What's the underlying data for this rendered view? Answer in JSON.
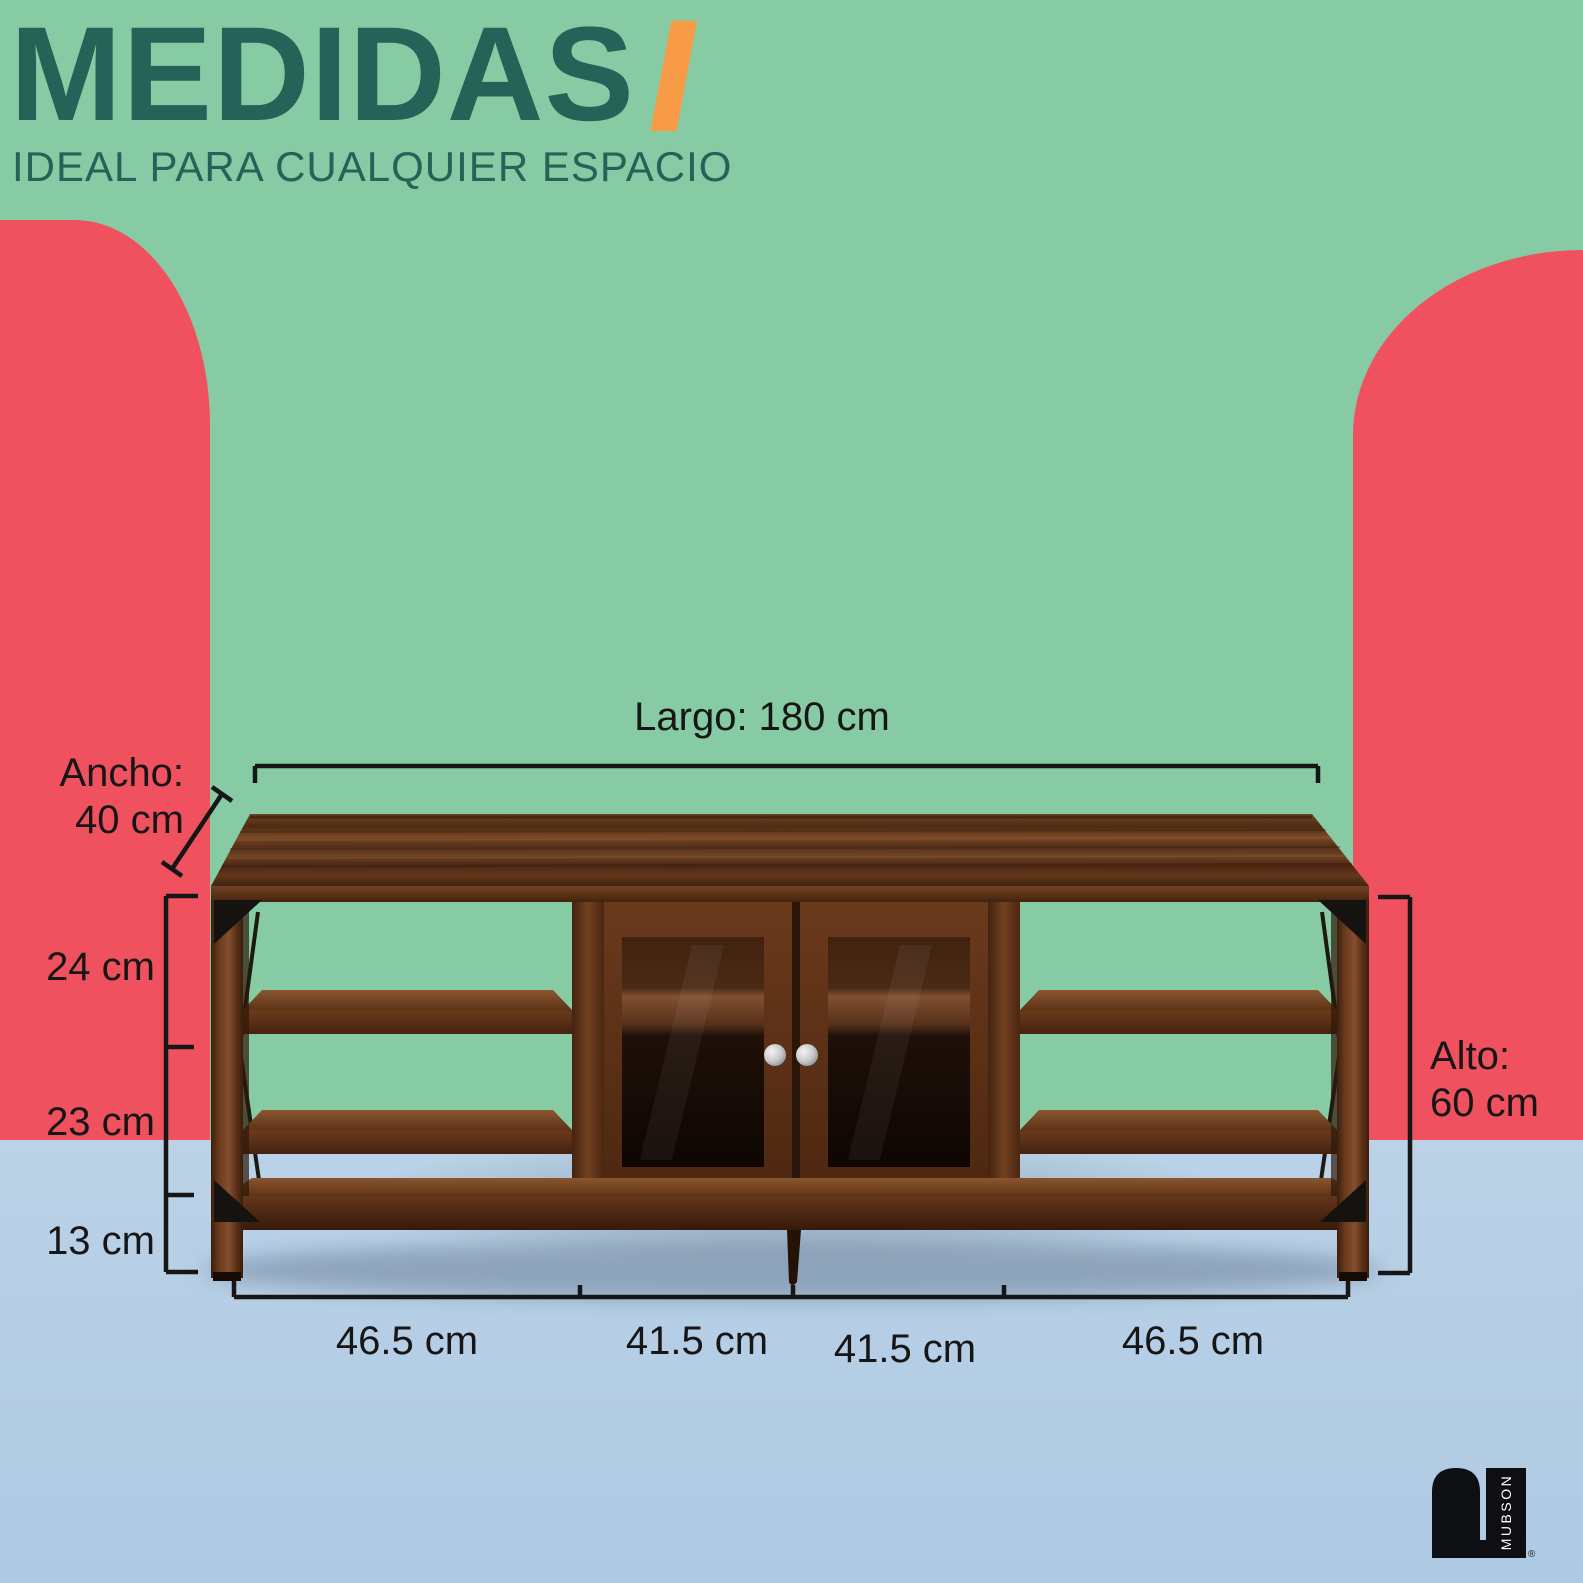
{
  "title": {
    "text": "MEDIDAS",
    "slashes": "//",
    "subtitle": "IDEAL PARA CUALQUIER ESPACIO"
  },
  "dimensions": {
    "length_label": "Largo: 180 cm",
    "width_label_line1": "Ancho:",
    "width_label_line2": "40 cm",
    "height_label_line1": "Alto:",
    "height_label_line2": "60 cm",
    "left_segments": [
      "24 cm",
      "23 cm",
      "13 cm"
    ],
    "bottom_segments": [
      "46.5 cm",
      "41.5 cm",
      "41.5 cm",
      "46.5 cm"
    ]
  },
  "logo": {
    "brand": "MUBSON",
    "registered": "®"
  },
  "colors": {
    "background_green": "#87CBA4",
    "floor_blue": "#B8CFE4",
    "accent_coral": "#F0515F",
    "title_teal": "#256358",
    "accent_orange": "#F79B47",
    "annotation_black": "#161616",
    "wood_brown": "#5C3117"
  }
}
